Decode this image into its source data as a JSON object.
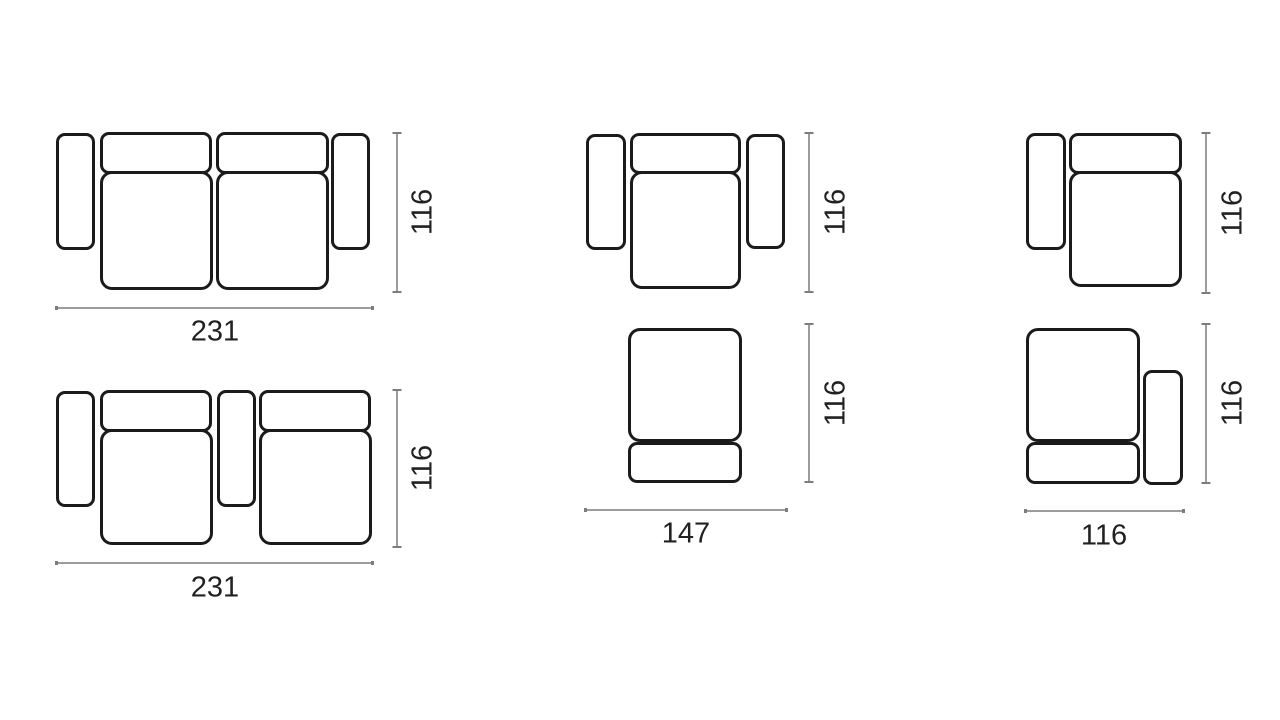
{
  "diagram": {
    "description": "Top-view dimension drawings of six modular sofa configurations",
    "colors": {
      "background": "#ffffff",
      "outline": "#1b1b1b",
      "dimension_line": "#9c9c9c",
      "dimension_tick": "#7d7d7d",
      "label_text": "#212121"
    }
  },
  "figures": [
    {
      "id": "two-seat-sofa-two-armrests",
      "width_label": "231",
      "height_label": "116"
    },
    {
      "id": "two-seat-sofa-center-console",
      "width_label": "231",
      "height_label": "116"
    },
    {
      "id": "armchair-two-armrests",
      "height_label": "116"
    },
    {
      "id": "armless-seat-module",
      "width_label": "147",
      "height_label": "116"
    },
    {
      "id": "seat-module-left-armrest",
      "height_label": "116"
    },
    {
      "id": "seat-module-right-armrest",
      "width_label": "116",
      "height_label": "116"
    }
  ]
}
